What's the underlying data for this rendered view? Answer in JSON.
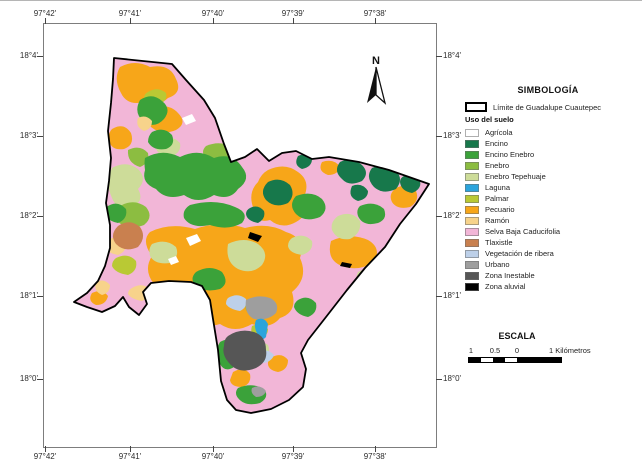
{
  "map": {
    "north_label": "N"
  },
  "axes": {
    "lon": [
      "97°42'",
      "97°41'",
      "97°40'",
      "97°39'",
      "97°38'"
    ],
    "lat": [
      "18°4'",
      "18°3'",
      "18°2'",
      "18°1'",
      "18°0'"
    ]
  },
  "legend": {
    "title": "SIMBOLOGÍA",
    "limit_label": "Límite de Guadalupe Cuautepec",
    "subtitle": "Uso del suelo",
    "items": [
      {
        "key": "agricola",
        "label": "Agrícola",
        "color": "#ffffff"
      },
      {
        "key": "encino",
        "label": "Encino",
        "color": "#17784b"
      },
      {
        "key": "encino_enebro",
        "label": "Encino Enebro",
        "color": "#3ba23a"
      },
      {
        "key": "enebro",
        "label": "Enebro",
        "color": "#8cbd41"
      },
      {
        "key": "enebro_tepehuaje",
        "label": "Enebro Tepehuaje",
        "color": "#cddc99"
      },
      {
        "key": "laguna",
        "label": "Laguna",
        "color": "#2ba4dc"
      },
      {
        "key": "palmar",
        "label": "Palmar",
        "color": "#b9c934"
      },
      {
        "key": "pecuario",
        "label": "Pecuario",
        "color": "#f7a619"
      },
      {
        "key": "ramon",
        "label": "Ramón",
        "color": "#f7d38b"
      },
      {
        "key": "selva",
        "label": "Selva Baja Caducifolia",
        "color": "#f2b6d7"
      },
      {
        "key": "tlaxistle",
        "label": "Tlaxistle",
        "color": "#c9804f"
      },
      {
        "key": "veg_ribera",
        "label": "Vegetación de ribera",
        "color": "#bdd0e9"
      },
      {
        "key": "urbano",
        "label": "Urbano",
        "color": "#9e9e9e"
      },
      {
        "key": "zona_inestable",
        "label": "Zona Inestable",
        "color": "#565656"
      },
      {
        "key": "zona_aluvial",
        "label": "Zona aluvial",
        "color": "#000000"
      }
    ]
  },
  "scale": {
    "title": "ESCALA",
    "tick_labels": [
      "1",
      "0.5",
      "0"
    ],
    "unit_label": "1 Kilómetros"
  }
}
